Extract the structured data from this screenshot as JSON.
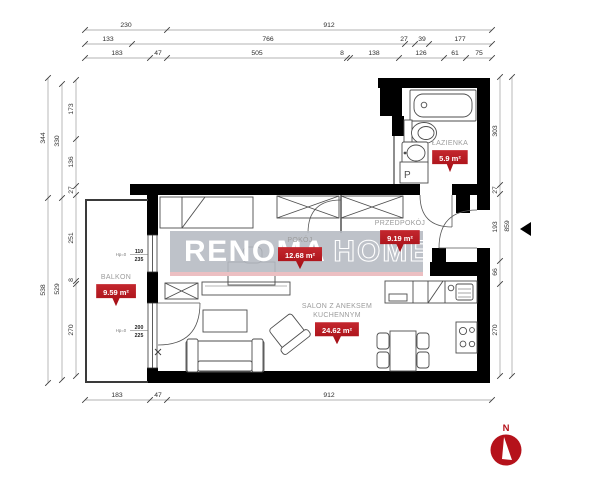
{
  "watermark": {
    "bold": "RENOMA",
    "outline": "HOME"
  },
  "compass": {
    "label": "N"
  },
  "rooms": {
    "balkon": {
      "name": "BALKON",
      "area": "9.59 m²"
    },
    "pokoj": {
      "name": "POKÓJ",
      "area": "12.68 m²"
    },
    "przedpokoj": {
      "name": "PRZEDPOKÓJ",
      "area": "9.19 m²"
    },
    "lazienka": {
      "name": "ŁAZIENKA",
      "area": "5.9 m²"
    },
    "salon": {
      "name_line1": "SALON Z ANEKSEM",
      "name_line2": "KUCHENNYM",
      "area": "24.62 m²"
    }
  },
  "openings": {
    "window": {
      "hp": "Hp=0",
      "width": "110",
      "height": "235"
    },
    "balcony_door": {
      "hp": "Hp=0",
      "width": "200",
      "height": "225"
    }
  },
  "fixtures": {
    "washing_machine": "P"
  },
  "dims": {
    "top_row1": [
      "230",
      "912"
    ],
    "top_row2": [
      "133",
      "766",
      "27",
      "39",
      "177"
    ],
    "top_row3": [
      "183",
      "47",
      "505",
      "8",
      "138",
      "126",
      "61",
      "75"
    ],
    "left_outer": [
      "344",
      "538"
    ],
    "left_middle": [
      "330",
      "529"
    ],
    "left_inner": [
      "173",
      "136",
      "27",
      "251",
      "8",
      "270"
    ],
    "right_inner": [
      "303",
      "27",
      "193",
      "66",
      "270"
    ],
    "right_outer": [
      "859"
    ],
    "bottom": [
      "183",
      "47",
      "912"
    ]
  },
  "colors": {
    "wall": "#000000",
    "badge_red": "#a30d14",
    "badge_red_light": "#c4272e",
    "compass_red": "#b5121b",
    "watermark_bg": "#b5bac2",
    "watermark_underline": "#ecbfc2",
    "label_gray": "#9b9b9b",
    "dim_text": "#2e2e2e"
  }
}
